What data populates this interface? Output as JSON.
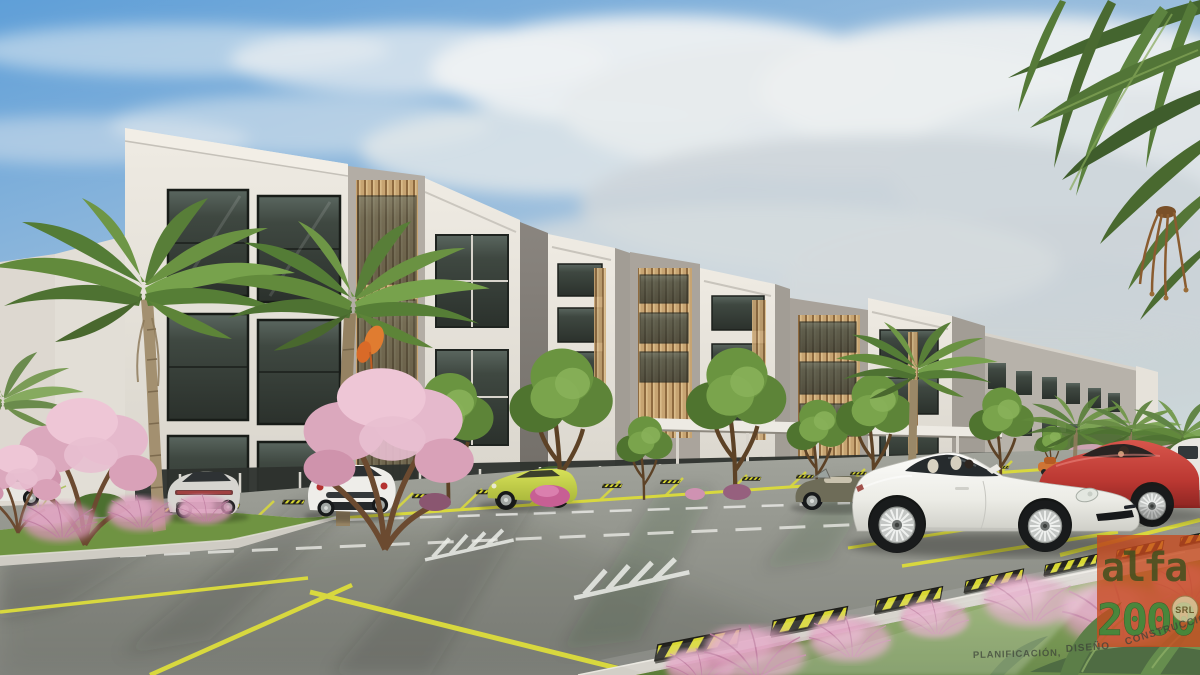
{
  "scene": {
    "subject": "3D exterior rendering of a modern four-story apartment complex with wood-slat accents, landscaped parking lot, palm trees and sports cars",
    "palette": {
      "sky_blue": "#5f9fd8",
      "cloud_white": "#eef1f2",
      "building_white": "#e9e5dd",
      "building_gray": "#a8a29a",
      "wood_slats": "#c7a472",
      "window_glass": "#353b36",
      "asphalt": "#94968e",
      "lot_line_yellow": "#d8d83e",
      "grass_green": "#6f9342",
      "tree_green": "#5d8438",
      "blossom_pink": "#e5b9cc",
      "muhly_pink": "#d795b6",
      "hazard_yellow": "#d8d832",
      "hazard_black": "#23231f"
    },
    "vehicles": [
      {
        "id": "white-coupe-far-left",
        "color": "#e8e7e2"
      },
      {
        "id": "silver-coupe-rear",
        "color": "#d6d5d0"
      },
      {
        "id": "white-sports-coupe-rear",
        "color": "#eeede9"
      },
      {
        "id": "lime-sports-car",
        "color": "#c8d44c"
      },
      {
        "id": "olive-convertible",
        "color": "#6e6c58"
      },
      {
        "id": "white-porsche-911",
        "color": "#f2f2ee"
      },
      {
        "id": "red-sports-coupe",
        "color": "#c23b35"
      },
      {
        "id": "white-suv-edge",
        "color": "#e9e7e1"
      },
      {
        "id": "orange-car-distant",
        "color": "#cf7434"
      }
    ]
  },
  "watermark": {
    "logo_alfa": "alfa",
    "logo_2000": "2000",
    "badge": "SRL",
    "tagline_1": "PLANIFICACIÓN,",
    "tagline_2": "DISEÑO",
    "tagline_3": "CONSTRUCCIÓN",
    "logo_color": "#c8491d",
    "logo_letters_color": "#45501f",
    "logo_2000_color": "#3f8a3c",
    "tagline_color": "#3c4238"
  }
}
